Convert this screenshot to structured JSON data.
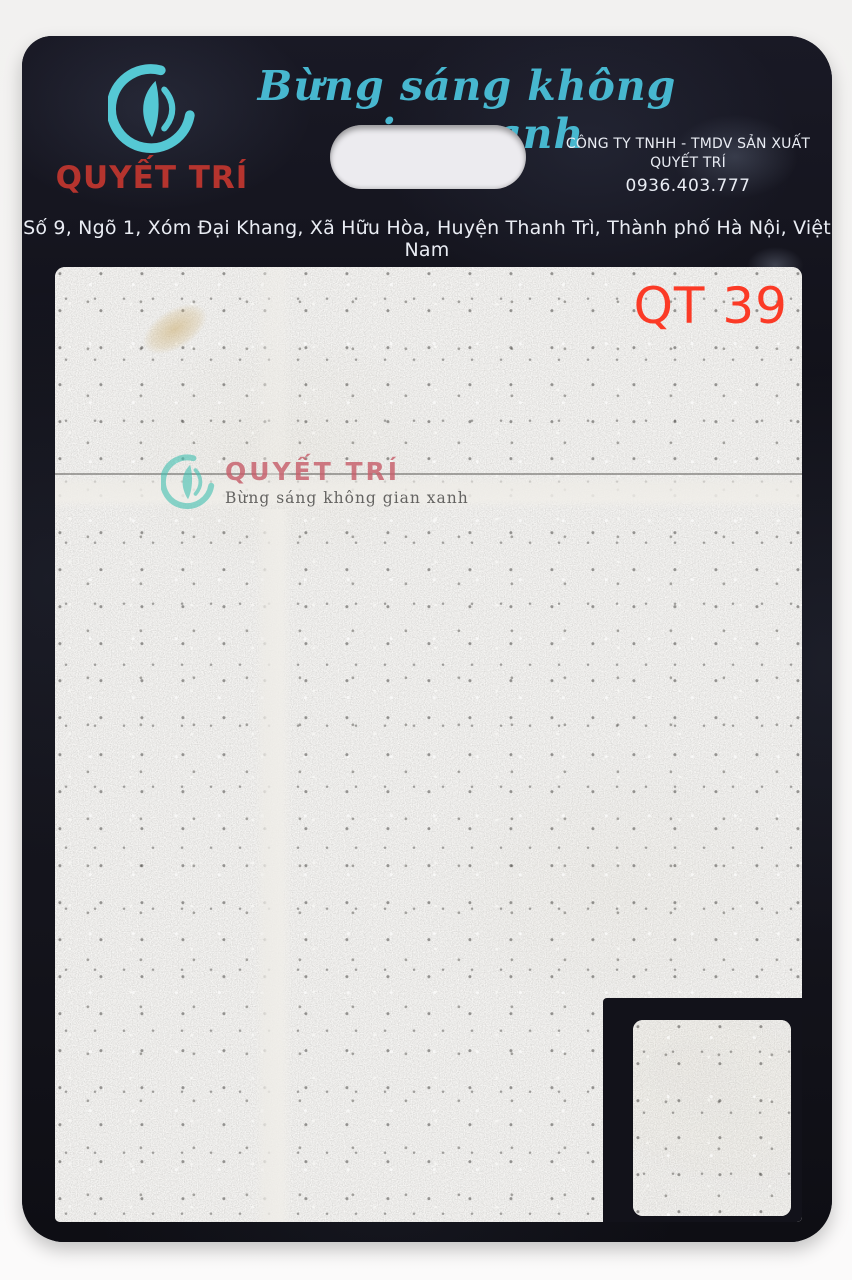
{
  "colors": {
    "page_bg": "#f4f3f2",
    "board_bg": "#14141c",
    "logo_teal": "#55c8d4",
    "slogan_teal": "#47b7cf",
    "brand_red": "#b5342e",
    "text_white": "#e9ecf3",
    "handle_fill": "#ecebef",
    "stone_base": "#d6d4d0",
    "grout_light": "#edebe6",
    "code_red": "#fb3a26",
    "watermark_teal": "#44c1b2",
    "watermark_red": "#c75f6b",
    "watermark_gray": "#474645",
    "notch_black": "#12121a"
  },
  "icons": {
    "brand_logo": "swirl-leaf-circle",
    "watermark_logo": "swirl-leaf-circle"
  },
  "header": {
    "slogan": "Bừng sáng không gian xanh",
    "brand": "QUYẾT TRÍ",
    "company": "CÔNG TY TNHH - TMDV SẢN XUẤT QUYẾT TRÍ",
    "phone": "0936.403.777",
    "address": "Số 9, Ngõ 1, Xóm Đại Khang, Xã Hữu Hòa, Huyện Thanh Trì, Thành phố Hà Nội, Việt Nam"
  },
  "sample": {
    "product_code": "QT 39",
    "watermark_brand": "QUYẾT TRÍ",
    "watermark_slogan": "Bừng sáng không gian xanh"
  }
}
